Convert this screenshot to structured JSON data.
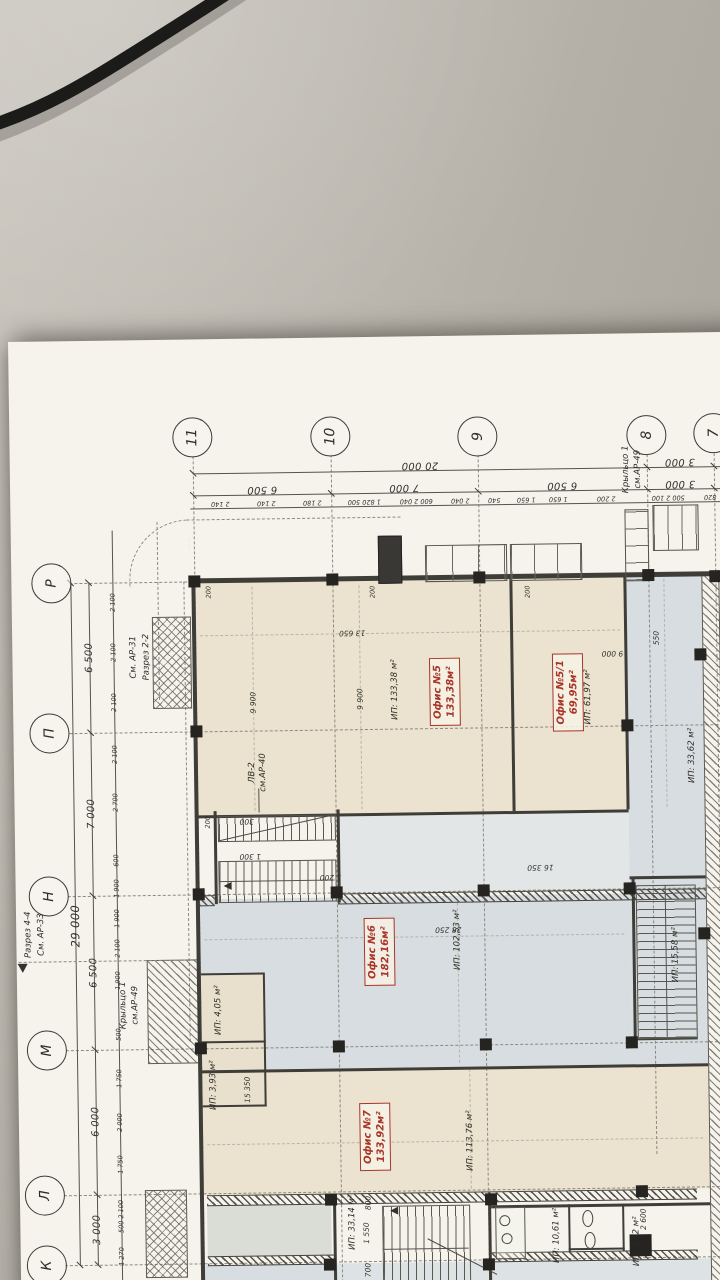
{
  "scene": {
    "desk_color": "#b3afa6",
    "cable_color": "#1b1b1a",
    "paper_color": "#f5f3ec",
    "description": "Photo of an architectural floor plan sheet lying on a grey desk with a black cable at top"
  },
  "colors": {
    "accent_red": "#a93428",
    "room_cream": "#ebe3cf",
    "room_blue": "#d7dde0",
    "line": "#3f3d38"
  },
  "plan": {
    "column_bubbles": [
      "11",
      "10",
      "9",
      "8",
      "7"
    ],
    "row_bubbles": [
      "Р",
      "П",
      "Н",
      "М",
      "Л",
      "К"
    ],
    "dims": {
      "top_major": [
        "20 000",
        "3 000"
      ],
      "top_minor": [
        "6 500",
        "7 000",
        "6 500",
        "3 000"
      ],
      "top_small": [
        "2 140",
        "2 140",
        "2 180",
        "1 820 500",
        "600 2 040",
        "2 040",
        "540",
        "1 650",
        "1 650",
        "2 200",
        "500 2 100",
        "820"
      ],
      "left_overall": "29 000",
      "left_major": [
        "6 500",
        "7 000",
        "6 500",
        "6 000",
        "3 000"
      ],
      "left_small": [
        "2 100",
        "2 100",
        "2 100",
        "2 100",
        "2 700",
        "600",
        "1 900",
        "1 900",
        "2 100",
        "1 900",
        "500",
        "1 750",
        "2 000",
        "1 750",
        "500 2 100",
        "1 270"
      ],
      "inner": [
        "13 650",
        "9 900",
        "9 900",
        "9 000",
        "550",
        "16 350",
        "28 250",
        "15 350",
        "1 550",
        "800",
        "700",
        "300",
        "1 300",
        "1 200",
        "2 600",
        "200",
        "200",
        "200",
        "200"
      ]
    },
    "annotations": [
      "См. АР-31",
      "Разрез 2-2",
      "Разрез 4-4",
      "См. АР-33",
      "Крыльцо 1",
      "см.АР-49",
      "Крыльцо 1",
      "см.АР-49",
      "ЛВ-2",
      "см.АР-40"
    ],
    "offices": [
      {
        "name": "Офис №5",
        "area": "133,38м²"
      },
      {
        "name": "Офис №5/1",
        "area": "69,95м²"
      },
      {
        "name": "Офис №6",
        "area": "182,16м²"
      },
      {
        "name": "Офис №7",
        "area": "133,92м²"
      }
    ],
    "rooms": [
      "ИП: 133,38 м²",
      "ИП: 61,97 м²",
      "ИП: 33,62 м²",
      "ИП: 102,53 м²",
      "ИП: 4,05 м²",
      "ИП: 3,93 м²",
      "ИП: 15,58 м²",
      "ИП: 113,76 м²",
      "ИП: 33,14 м²",
      "ИП: 10,61 м²",
      "ИП: 5,62 м²"
    ]
  }
}
